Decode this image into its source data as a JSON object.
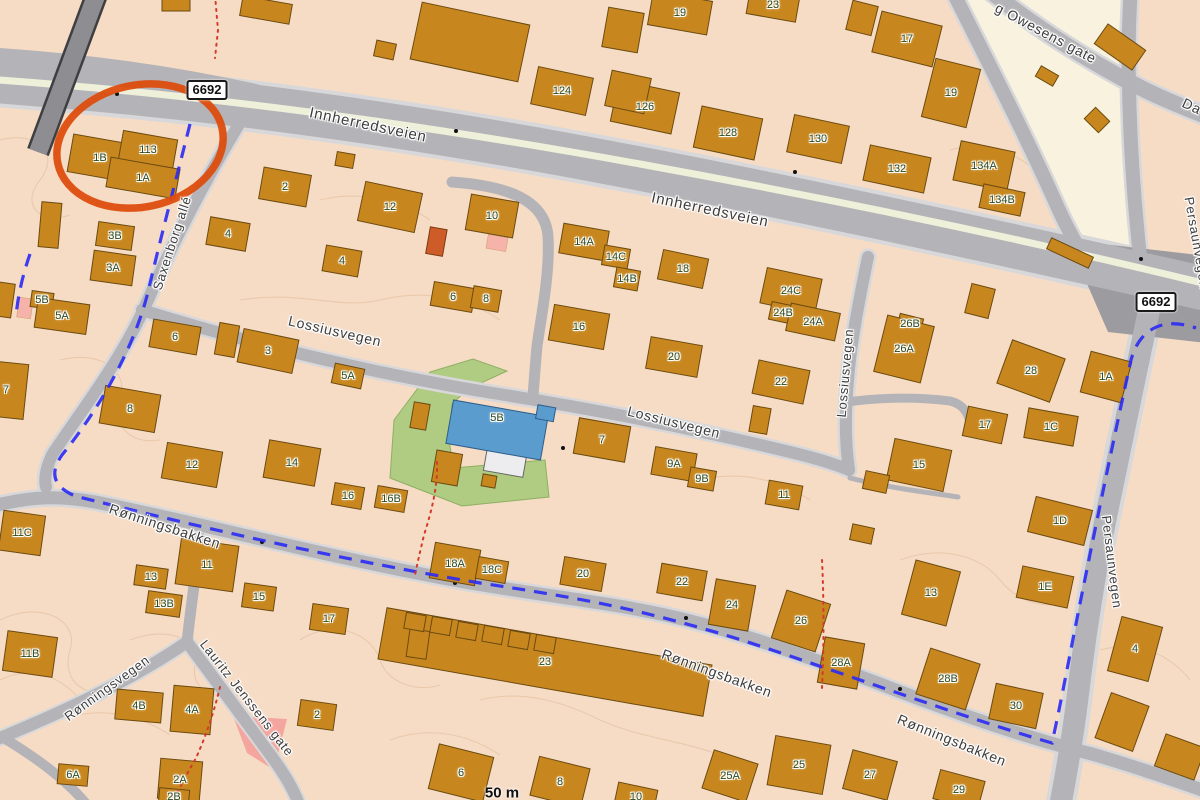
{
  "map": {
    "scale_label": "50 m",
    "road_number_badges": [
      {
        "text": "6692",
        "x": 207,
        "y": 90
      },
      {
        "text": "6692",
        "x": 1156,
        "y": 302
      }
    ],
    "streets": [
      {
        "name": "Innherredsveien",
        "x": 368,
        "y": 125,
        "rot": 12,
        "size": 15
      },
      {
        "name": "Innherredsveien",
        "x": 710,
        "y": 210,
        "rot": 12,
        "size": 15
      },
      {
        "name": "Saxenborg allé",
        "x": 172,
        "y": 243,
        "rot": -72,
        "size": 13
      },
      {
        "name": "Lossiusvegen",
        "x": 335,
        "y": 331,
        "rot": 13,
        "size": 14
      },
      {
        "name": "Lossiusvegen",
        "x": 674,
        "y": 422,
        "rot": 14,
        "size": 14
      },
      {
        "name": "Lossiusvegen",
        "x": 845,
        "y": 373,
        "rot": -85,
        "size": 13
      },
      {
        "name": "Rønningsbakken",
        "x": 165,
        "y": 526,
        "rot": 18,
        "size": 14
      },
      {
        "name": "Rønningsbakken",
        "x": 717,
        "y": 673,
        "rot": 20,
        "size": 14
      },
      {
        "name": "Rønningsbakken",
        "x": 952,
        "y": 740,
        "rot": 22,
        "size": 14
      },
      {
        "name": "Rønningsvegen",
        "x": 107,
        "y": 688,
        "rot": -36,
        "size": 13
      },
      {
        "name": "Lauritz Jenssens gate",
        "x": 247,
        "y": 698,
        "rot": 52,
        "size": 13
      },
      {
        "name": "Persaunvegen",
        "x": 1112,
        "y": 562,
        "rot": 83,
        "size": 13
      },
      {
        "name": "Persaunvegen",
        "x": 1197,
        "y": 243,
        "rot": 80,
        "size": 13
      },
      {
        "name": "g Owesens gate",
        "x": 1046,
        "y": 33,
        "rot": 28,
        "size": 14
      },
      {
        "name": "Da",
        "x": 1192,
        "y": 106,
        "rot": 25,
        "size": 14
      }
    ],
    "buildings": [
      [
        100,
        158,
        60,
        38,
        10,
        "1B"
      ],
      [
        148,
        150,
        55,
        30,
        10,
        "113"
      ],
      [
        143,
        178,
        70,
        30,
        10,
        "1A"
      ],
      [
        115,
        236,
        36,
        24,
        8,
        "3B"
      ],
      [
        113,
        268,
        42,
        30,
        8,
        "3A"
      ],
      [
        42,
        300,
        22,
        16,
        8,
        "5B"
      ],
      [
        62,
        316,
        52,
        30,
        8,
        "5A"
      ],
      [
        285,
        187,
        48,
        32,
        10,
        "2"
      ],
      [
        228,
        234,
        40,
        28,
        10,
        "4"
      ],
      [
        390,
        207,
        58,
        40,
        12,
        "12"
      ],
      [
        492,
        216,
        48,
        36,
        10,
        "10"
      ],
      [
        342,
        261,
        36,
        26,
        10,
        "4"
      ],
      [
        453,
        297,
        42,
        24,
        10,
        "6"
      ],
      [
        486,
        299,
        28,
        22,
        10,
        "8"
      ],
      [
        175,
        337,
        48,
        28,
        10,
        "6"
      ],
      [
        268,
        351,
        56,
        34,
        12,
        "3"
      ],
      [
        348,
        376,
        30,
        20,
        12,
        "5A"
      ],
      [
        130,
        409,
        56,
        38,
        10,
        "8"
      ],
      [
        6,
        390,
        40,
        55,
        6,
        "7"
      ],
      [
        192,
        465,
        56,
        36,
        10,
        "12"
      ],
      [
        292,
        463,
        52,
        38,
        10,
        "14"
      ],
      [
        348,
        496,
        30,
        22,
        10,
        "16"
      ],
      [
        391,
        499,
        30,
        22,
        10,
        "16B"
      ],
      [
        562,
        91,
        56,
        38,
        12,
        "124"
      ],
      [
        645,
        107,
        62,
        42,
        12,
        "126"
      ],
      [
        728,
        133,
        62,
        42,
        12,
        "128"
      ],
      [
        818,
        139,
        56,
        38,
        12,
        "130"
      ],
      [
        897,
        169,
        62,
        36,
        12,
        "132"
      ],
      [
        984,
        166,
        55,
        40,
        12,
        "134A"
      ],
      [
        1002,
        200,
        42,
        24,
        12,
        "134B"
      ],
      [
        680,
        13,
        60,
        34,
        10,
        "19"
      ],
      [
        773,
        5,
        50,
        26,
        10,
        "23"
      ],
      [
        907,
        39,
        62,
        42,
        14,
        "17"
      ],
      [
        951,
        93,
        46,
        60,
        14,
        "19"
      ],
      [
        584,
        242,
        46,
        30,
        10,
        "14A"
      ],
      [
        616,
        257,
        26,
        20,
        10,
        "14C"
      ],
      [
        627,
        279,
        24,
        20,
        10,
        "14B"
      ],
      [
        683,
        269,
        46,
        30,
        12,
        "18"
      ],
      [
        791,
        291,
        56,
        36,
        12,
        "24C"
      ],
      [
        783,
        313,
        26,
        18,
        12,
        "24B"
      ],
      [
        813,
        322,
        50,
        28,
        12,
        "24A"
      ],
      [
        579,
        327,
        56,
        36,
        10,
        "16"
      ],
      [
        674,
        357,
        52,
        32,
        10,
        "20"
      ],
      [
        781,
        382,
        52,
        34,
        12,
        "22"
      ],
      [
        910,
        324,
        24,
        16,
        14,
        "26B"
      ],
      [
        904,
        349,
        48,
        58,
        14,
        "26A"
      ],
      [
        1031,
        371,
        56,
        46,
        20,
        "28"
      ],
      [
        1106,
        377,
        42,
        42,
        15,
        "1A"
      ],
      [
        497,
        418,
        0,
        0,
        10,
        "5B"
      ],
      [
        602,
        440,
        52,
        36,
        10,
        "7"
      ],
      [
        674,
        464,
        42,
        28,
        10,
        "9A"
      ],
      [
        702,
        479,
        26,
        20,
        10,
        "9B"
      ],
      [
        985,
        425,
        40,
        30,
        12,
        "17"
      ],
      [
        1051,
        427,
        50,
        30,
        10,
        "1C"
      ],
      [
        919,
        465,
        58,
        42,
        12,
        "15"
      ],
      [
        784,
        495,
        34,
        24,
        10,
        "11"
      ],
      [
        1060,
        521,
        58,
        36,
        14,
        "1D"
      ],
      [
        1045,
        587,
        52,
        32,
        12,
        "1E"
      ],
      [
        22,
        533,
        42,
        40,
        8,
        "11C"
      ],
      [
        207,
        565,
        58,
        46,
        8,
        "11"
      ],
      [
        151,
        577,
        32,
        20,
        8,
        "13"
      ],
      [
        164,
        604,
        34,
        22,
        8,
        "13B"
      ],
      [
        30,
        654,
        50,
        40,
        8,
        "11B"
      ],
      [
        259,
        597,
        32,
        24,
        8,
        "15"
      ],
      [
        329,
        619,
        36,
        26,
        8,
        "17"
      ],
      [
        455,
        564,
        46,
        36,
        10,
        "18A"
      ],
      [
        492,
        570,
        30,
        22,
        10,
        "18C"
      ],
      [
        583,
        574,
        42,
        28,
        10,
        "20"
      ],
      [
        682,
        582,
        46,
        30,
        10,
        "22"
      ],
      [
        732,
        605,
        40,
        46,
        10,
        "24"
      ],
      [
        801,
        621,
        46,
        50,
        18,
        "26"
      ],
      [
        931,
        593,
        46,
        56,
        15,
        "13"
      ],
      [
        841,
        663,
        40,
        46,
        10,
        "28A"
      ],
      [
        948,
        679,
        52,
        48,
        18,
        "28B"
      ],
      [
        1016,
        706,
        48,
        36,
        12,
        "30"
      ],
      [
        317,
        715,
        36,
        26,
        8,
        "2"
      ],
      [
        139,
        706,
        46,
        30,
        5,
        "4B"
      ],
      [
        192,
        710,
        40,
        46,
        5,
        "4A"
      ],
      [
        73,
        775,
        30,
        20,
        5,
        "6A"
      ],
      [
        180,
        780,
        42,
        40,
        5,
        "2A"
      ],
      [
        174,
        797,
        30,
        16,
        5,
        "2B"
      ],
      [
        545,
        662,
        330,
        52,
        10,
        "23"
      ],
      [
        461,
        773,
        56,
        46,
        14,
        "6"
      ],
      [
        560,
        782,
        52,
        40,
        14,
        "8"
      ],
      [
        636,
        797,
        40,
        22,
        12,
        "10"
      ],
      [
        730,
        776,
        46,
        40,
        18,
        "25A"
      ],
      [
        799,
        765,
        56,
        50,
        10,
        "25"
      ],
      [
        870,
        775,
        46,
        40,
        15,
        "27"
      ],
      [
        959,
        790,
        46,
        30,
        15,
        "29"
      ],
      [
        1135,
        649,
        42,
        56,
        15,
        "4"
      ],
      [
        176,
        5,
        28,
        12,
        0,
        ""
      ],
      [
        266,
        10,
        50,
        20,
        10,
        ""
      ],
      [
        470,
        42,
        110,
        58,
        12,
        ""
      ],
      [
        623,
        30,
        36,
        40,
        10,
        ""
      ],
      [
        628,
        92,
        40,
        36,
        12,
        ""
      ],
      [
        385,
        50,
        20,
        16,
        12,
        ""
      ],
      [
        345,
        160,
        18,
        14,
        10,
        ""
      ],
      [
        862,
        18,
        26,
        30,
        14,
        ""
      ],
      [
        1120,
        47,
        46,
        24,
        35,
        ""
      ],
      [
        1047,
        76,
        20,
        12,
        30,
        ""
      ],
      [
        1097,
        120,
        20,
        16,
        45,
        ""
      ],
      [
        50,
        225,
        20,
        45,
        5,
        ""
      ],
      [
        5,
        300,
        16,
        34,
        8,
        ""
      ],
      [
        227,
        340,
        20,
        32,
        10,
        ""
      ],
      [
        420,
        416,
        16,
        26,
        10,
        ""
      ],
      [
        447,
        468,
        26,
        32,
        10,
        ""
      ],
      [
        489,
        481,
        14,
        12,
        10,
        ""
      ],
      [
        760,
        420,
        18,
        26,
        10,
        ""
      ],
      [
        876,
        482,
        24,
        18,
        12,
        ""
      ],
      [
        980,
        301,
        24,
        30,
        14,
        ""
      ],
      [
        1070,
        253,
        46,
        12,
        25,
        ""
      ],
      [
        862,
        534,
        22,
        16,
        12,
        ""
      ],
      [
        418,
        644,
        20,
        28,
        8,
        ""
      ],
      [
        1122,
        722,
        40,
        48,
        20,
        ""
      ],
      [
        1180,
        757,
        42,
        34,
        20,
        ""
      ],
      [
        415,
        622,
        20,
        16,
        10,
        ""
      ],
      [
        441,
        626,
        20,
        16,
        10,
        ""
      ],
      [
        467,
        631,
        20,
        16,
        10,
        ""
      ],
      [
        493,
        635,
        20,
        16,
        10,
        ""
      ],
      [
        519,
        640,
        20,
        16,
        10,
        ""
      ],
      [
        545,
        644,
        20,
        16,
        10,
        ""
      ]
    ],
    "annotation": {
      "shape": "ellipse",
      "cx": 140,
      "cy": 146,
      "rx": 84,
      "ry": 61,
      "rot": -12,
      "color": "#dd4d0e",
      "stroke_width": 7.5
    },
    "colors": {
      "land": "#f6dcc5",
      "land_light": "#f8f2df",
      "building": "#c8871e",
      "building_outline": "#6b4a10",
      "road_major": "#9c9ca0",
      "road_minor": "#b4b4b8",
      "road_casing": "#d8d8da",
      "median_stripe": "#eef0d9",
      "park": "#afcc82",
      "public_building": "#5b9ccf",
      "pink_zone": "#f4a59d",
      "cycle_route": "#2a2af5",
      "footpath": "#d43a2a",
      "highlight": "#dd4d0e"
    }
  }
}
